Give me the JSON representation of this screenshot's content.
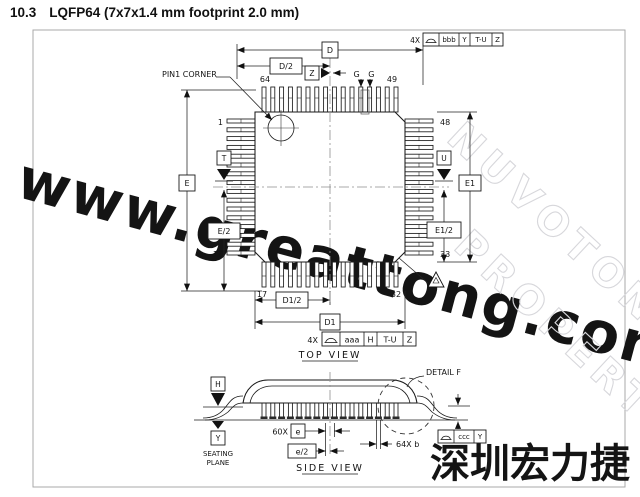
{
  "page": {
    "section": "10.3",
    "title": "LQFP64 (7x7x1.4 mm footprint 2.0 mm)"
  },
  "watermarks": {
    "site": "www.greattong.com",
    "property_line1": "NUVOTON",
    "property_line2": "PROPERTY",
    "chinese": "深圳宏力捷",
    "site_color": "#cfe1f5",
    "property_color": "#d7d7db",
    "chinese_color": "#8ab7e9"
  },
  "drawing": {
    "views": {
      "top": "TOP VIEW",
      "side": "SIDE VIEW"
    },
    "labels": {
      "pin1_corner": "PIN1 CORNER",
      "detail_f": "DETAIL F",
      "seating_line1": "SEATING",
      "seating_line2": "PLANE"
    },
    "pins": {
      "p1": "1",
      "p16": "16",
      "p17": "17",
      "p32": "32",
      "p33": "33",
      "p48": "48",
      "p49": "49",
      "p64": "64"
    },
    "dims": {
      "D": "D",
      "D_half": "D/2",
      "D1": "D1",
      "D1_half": "D1/2",
      "E": "E",
      "E_half": "E/2",
      "E1": "E1",
      "E1_half": "E1/2",
      "pitch": "e",
      "pitch_half": "e/2",
      "pitch_count": "60X",
      "lead_width": "64X  b",
      "section": "G G"
    },
    "datums": {
      "T": "T",
      "U": "U",
      "Z": "Z",
      "H": "H",
      "Y": "Y"
    },
    "fcf_top": {
      "prefix": "4X",
      "symbol": "profile-of-surface",
      "tolerance": "bbb",
      "datum_a": "Y",
      "datum_b": "T-U",
      "datum_c": "Z"
    },
    "fcf_bottom": {
      "prefix": "4X",
      "symbol": "profile-of-surface",
      "tolerance": "aaa",
      "datum_a": "H",
      "datum_b": "T-U",
      "datum_c": "Z"
    },
    "fcf_side": {
      "symbol": "profile-of-surface",
      "tolerance": "ccc",
      "datum_a": "Y"
    }
  }
}
